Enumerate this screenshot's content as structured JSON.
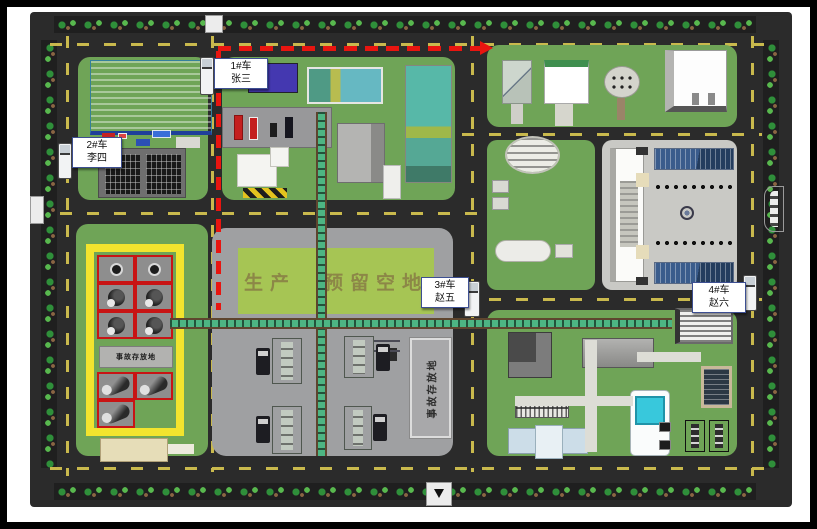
{
  "map": {
    "kind": "factory-site-plan",
    "colors": {
      "route_red": "#e81510",
      "block_green": "#6fa457",
      "center_pad_gray": "#9fa0a2",
      "office_pad_gray": "#c9c9c5",
      "road_dash_yellow": "#c9b94d",
      "enclosure_yellow": "#f2e42e",
      "tank_cell_red": "#c81414",
      "conveyor_green": "#4db583",
      "warehouse_blue": "#5ec3e6",
      "pond_teal": "#55ae9d",
      "pool_cyan": "#38c8dc",
      "production_sign_green": "#a6c554"
    }
  },
  "vehicles": [
    {
      "id": "1",
      "line1": "1#车",
      "line2": "张三"
    },
    {
      "id": "2",
      "line1": "2#车",
      "line2": "李四"
    },
    {
      "id": "3",
      "line1": "3#车",
      "line2": "赵五"
    },
    {
      "id": "4",
      "line1": "4#车",
      "line2": "赵六"
    }
  ],
  "signs": {
    "production_part1": "生产",
    "production_part2": "预留空地",
    "accident_storage_left": "事故存放地",
    "accident_storage_center": "事故存放地"
  }
}
